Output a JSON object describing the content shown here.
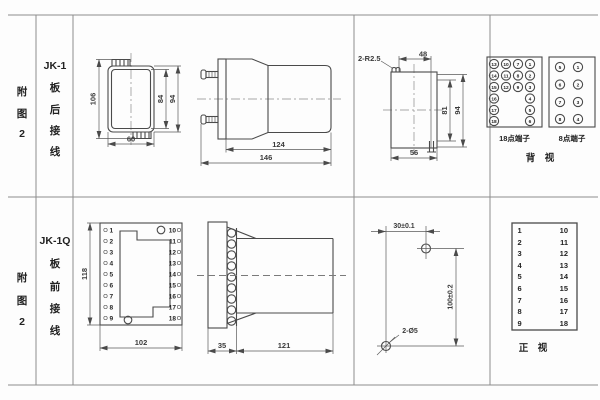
{
  "panel_top": {
    "figure_label": [
      "附",
      "图",
      "2"
    ],
    "model": "JK-1",
    "wiring_label": [
      "板",
      "后",
      "接",
      "线"
    ],
    "front_view": {
      "dim_overall_h": "106",
      "dim_inner_h": "84",
      "dim_case_h": "94",
      "dim_w": "60"
    },
    "side_view": {
      "dim_depth_inner": "124",
      "dim_depth_overall": "146"
    },
    "cutout_view": {
      "note_radius": "2-R2.5",
      "dim_top_w": "48",
      "dim_inner_h": "81",
      "dim_h": "94",
      "dim_bottom_w": "56"
    },
    "terminal18": {
      "label": "18点端子",
      "cells": [
        "13",
        "10",
        "7",
        "1",
        "14",
        "11",
        "8",
        "2",
        "15",
        "12",
        "9",
        "3",
        "16",
        "4",
        "17",
        "5",
        "18",
        "6"
      ]
    },
    "terminal8": {
      "label": "8点端子",
      "cells": [
        "5",
        "1",
        "6",
        "2",
        "7",
        "3",
        "8",
        "4"
      ]
    },
    "view_label": "背　视"
  },
  "panel_bottom": {
    "figure_label": [
      "附",
      "图",
      "2"
    ],
    "model": "JK-1Q",
    "wiring_label": [
      "板",
      "前",
      "接",
      "线"
    ],
    "plate_view": {
      "dim_h": "118",
      "dim_w": "102",
      "left_terminals": [
        "1",
        "2",
        "3",
        "4",
        "5",
        "6",
        "7",
        "8",
        "9"
      ],
      "right_terminals": [
        "10",
        "11",
        "12",
        "13",
        "14",
        "15",
        "16",
        "17",
        "18"
      ]
    },
    "side_view": {
      "dim_flange": "35",
      "dim_body": "121"
    },
    "drill_view": {
      "dim_spacing_h": "30±0.1",
      "dim_spacing_v": "100±0.2",
      "note_holes": "2-Ø5"
    },
    "terminal_table": {
      "left": [
        "1",
        "2",
        "3",
        "4",
        "5",
        "6",
        "7",
        "8",
        "9"
      ],
      "right": [
        "10",
        "11",
        "12",
        "13",
        "14",
        "15",
        "16",
        "17",
        "18"
      ]
    },
    "view_label": "正　视"
  }
}
